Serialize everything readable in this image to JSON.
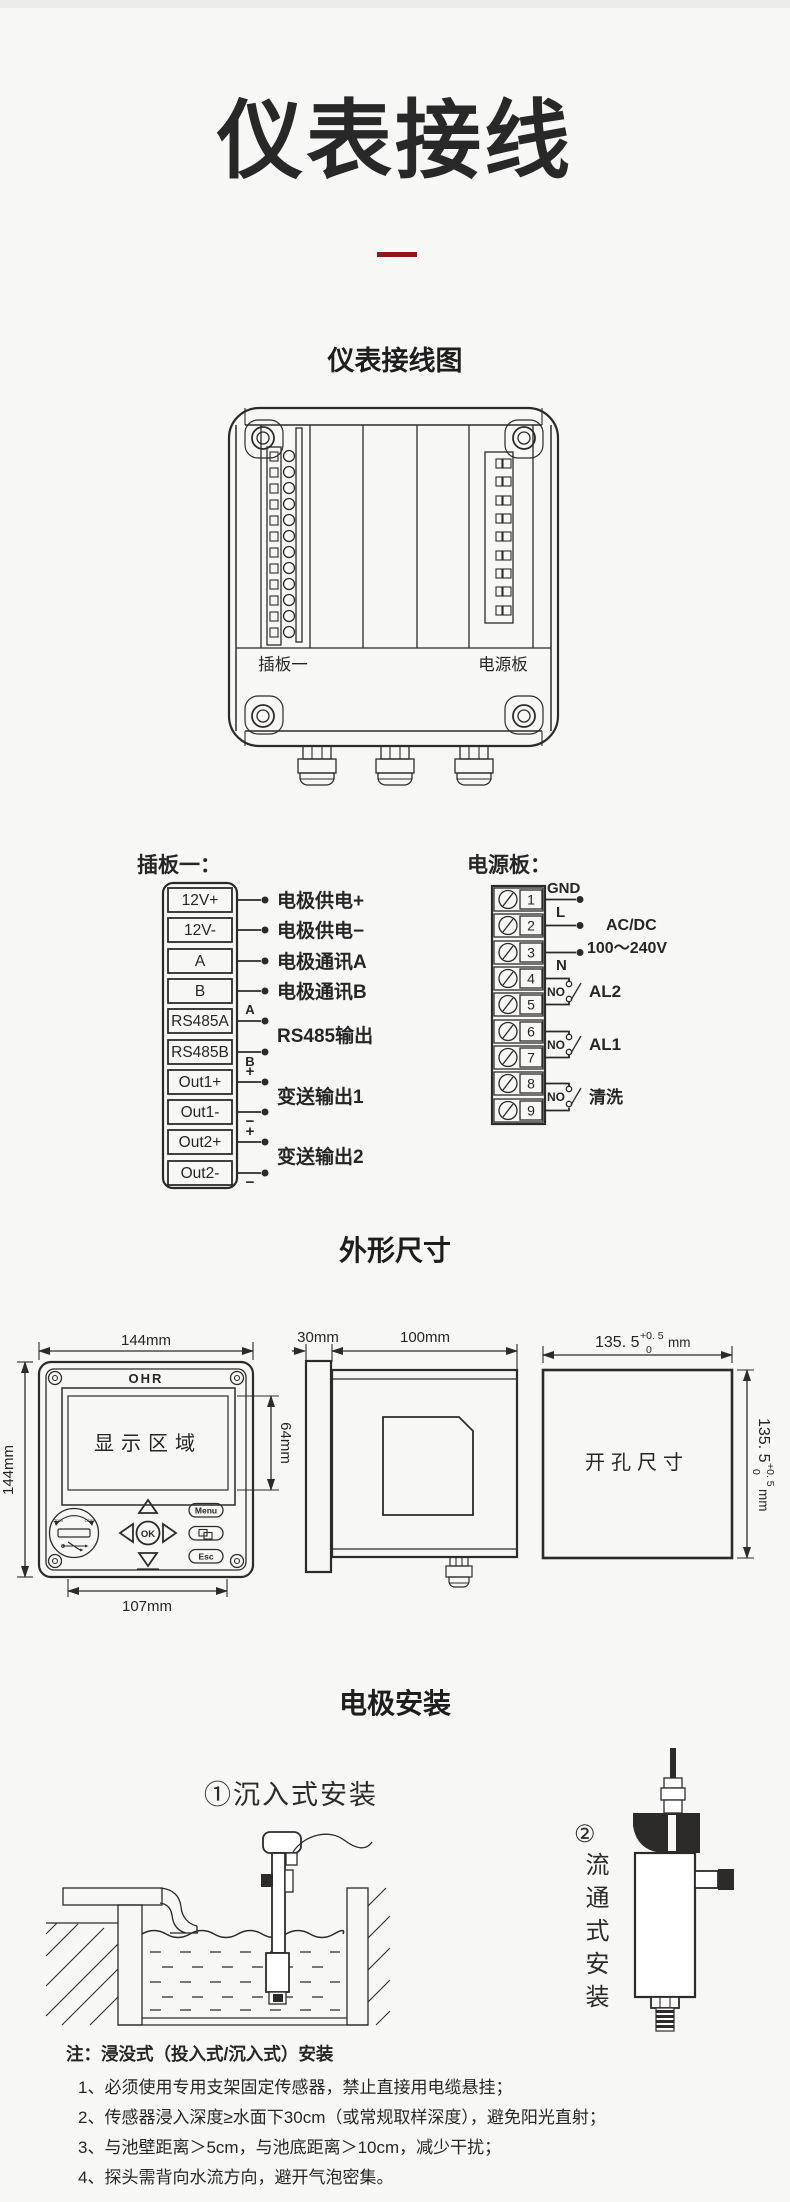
{
  "page": {
    "title": "仪表接线",
    "accent": "#8e161b"
  },
  "sections": {
    "wiring": "仪表接线图",
    "dimensions": "外形尺寸",
    "install": "电极安装"
  },
  "device": {
    "left_label": "插板一",
    "right_label": "电源板"
  },
  "plugboard": {
    "heading": "插板一：",
    "terminals": [
      "12V+",
      "12V-",
      "A",
      "B",
      "RS485A",
      "RS485B",
      "Out1+",
      "Out1-",
      "Out2+",
      "Out2-"
    ],
    "rows": [
      "电极供电+",
      "电极供电−",
      "电极通讯A",
      "电极通讯B"
    ],
    "rs485_label": "RS485输出",
    "rs485_a": "A",
    "rs485_b": "B",
    "out1_label": "变送输出1",
    "out2_label": "变送输出2",
    "plus": "+",
    "minus": "−"
  },
  "powerboard": {
    "heading": "电源板：",
    "numbers": [
      "1",
      "2",
      "3",
      "4",
      "5",
      "6",
      "7",
      "8",
      "9"
    ],
    "gnd": "GND",
    "live": "L",
    "neutral": "N",
    "supply_line1": "AC/DC",
    "supply_line2": "100～240V",
    "no": "NO",
    "al2": "AL2",
    "al1": "AL1",
    "clean": "清洗"
  },
  "front": {
    "brand": "OHR",
    "display_label": "显示区域",
    "dim_width": "144mm",
    "dim_height": "144mm",
    "dim_display_height": "64mm",
    "dim_panel_width": "107mm",
    "btn_ok": "OK",
    "btn_menu": "Menu",
    "btn_esc": "Esc",
    "dial_open": "Open",
    "dial_close": "Close"
  },
  "side": {
    "dim_bezel": "30mm",
    "dim_body": "100mm"
  },
  "cutout": {
    "label": "开孔尺寸",
    "value": "135. 5",
    "tol_plus": "+0. 5",
    "tol_zero": "0",
    "unit": "mm"
  },
  "install": {
    "method1": "①沉入式安装",
    "method2_num": "②",
    "method2_text": "流通式安装",
    "note_title": "注：浸没式（投入式/沉入式）安装",
    "notes": [
      "1、必须使用专用支架固定传感器，禁止直接用电缆悬挂；",
      "2、传感器浸入深度≥水面下30cm（或常规取样深度），避免阳光直射；",
      "3、与池壁距离＞5cm，与池底距离＞10cm，减少干扰；",
      "4、探头需背向水流方向，避开气泡密集。"
    ]
  }
}
